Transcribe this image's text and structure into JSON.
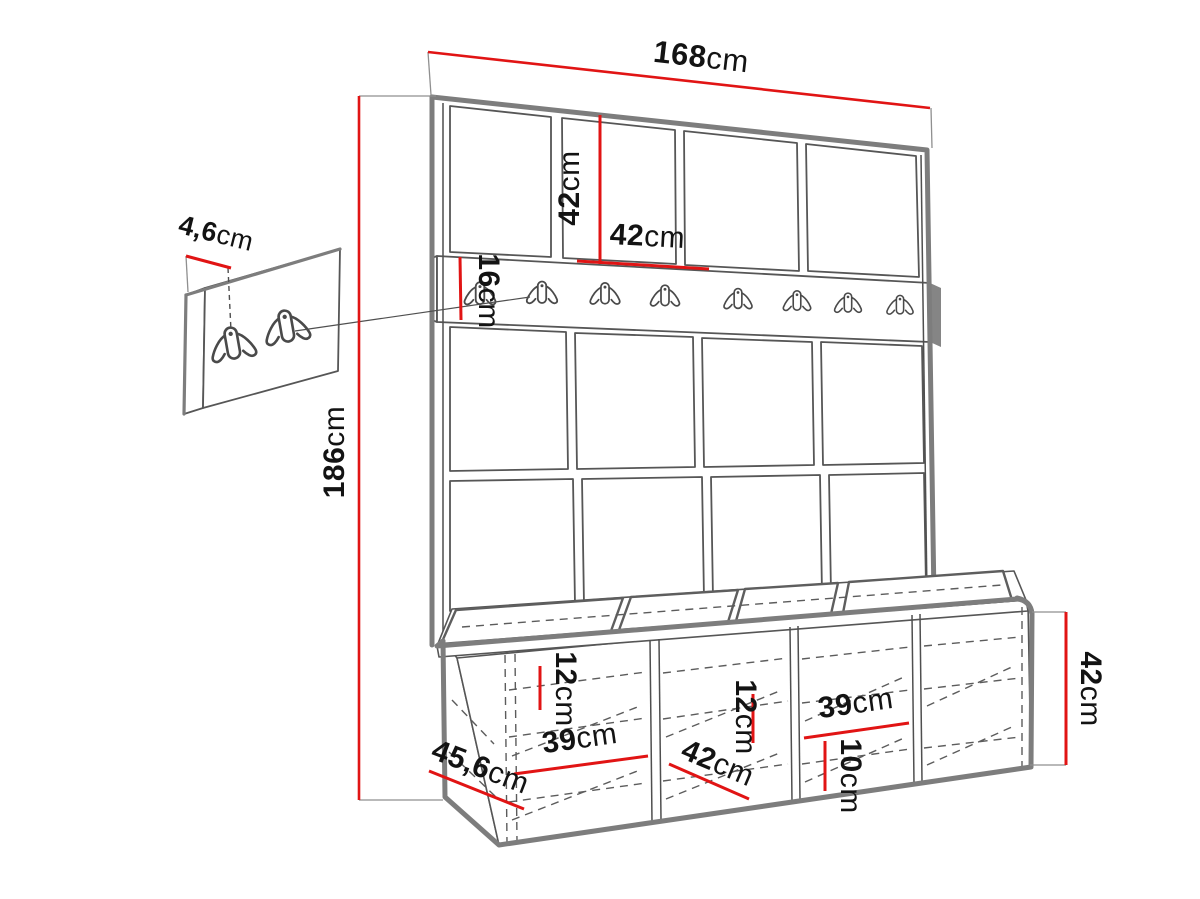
{
  "diagram": {
    "type": "furniture-dimension-drawing",
    "subject": "hall wardrobe set: upholstered wall panel grid, coat hook rail, storage bench with cushions, separate small hook panel",
    "unit_suffix": "cm",
    "hook_count_rail": 8,
    "hook_count_small_panel": 2
  },
  "colors": {
    "dimension_line": "#e11414",
    "outline_gray": "#7d7d7d",
    "drawing_line": "#4f4f4f",
    "background": "#ffffff",
    "text": "#131313"
  },
  "dims": {
    "total_width": {
      "value": "168",
      "unit": "cm"
    },
    "square_height": {
      "value": "42",
      "unit": "cm"
    },
    "square_width": {
      "value": "42",
      "unit": "cm"
    },
    "rail_height": {
      "value": "16",
      "unit": "cm"
    },
    "panel_thickness": {
      "value": "4,6",
      "unit": "cm"
    },
    "total_height": {
      "value": "186",
      "unit": "cm"
    },
    "shelf_left": {
      "value": "12",
      "unit": "cm"
    },
    "inner_width_left": {
      "value": "39",
      "unit": "cm"
    },
    "depth": {
      "value": "45,6",
      "unit": "cm"
    },
    "inner_width_mid": {
      "value": "42",
      "unit": "cm"
    },
    "shelf_mid": {
      "value": "12",
      "unit": "cm"
    },
    "inner_width_right": {
      "value": "39",
      "unit": "cm"
    },
    "shelf_right": {
      "value": "10",
      "unit": "cm"
    },
    "bench_height": {
      "value": "42",
      "unit": "cm"
    }
  }
}
